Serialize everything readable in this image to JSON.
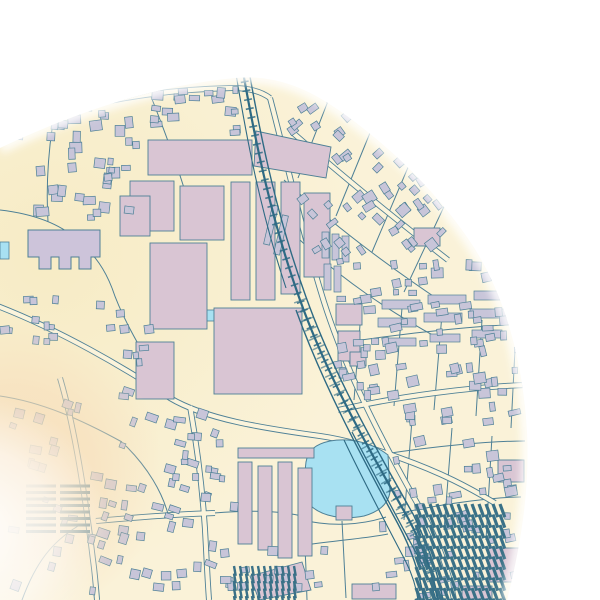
{
  "map": {
    "size": {
      "w": 600,
      "h": 600
    },
    "palette": {
      "land": "#faf2d8",
      "road_fill": "#fbf4dc",
      "west_tint": "#f5e8bb",
      "line": "#4e8096",
      "industrial": "#d9c5d3",
      "residential": "#c8c5d9",
      "landmark": "#cdc4da",
      "water": "#a8e1f2",
      "rail": "#2e6a84",
      "hatch": "#3a7187",
      "fade_peach": "#f7ddba",
      "outside": "#ffffff"
    },
    "mask": {
      "path": "M 0,148 C 70,115 150,86 235,78 C 282,74 315,93 347,116 C 392,149 436,191 471,243 C 505,294 523,362 527,432 C 530,492 520,548 507,600 L 0,600 Z",
      "edge_path": "M 0,148 C 70,115 150,86 235,78 C 282,74 315,93 347,116 C 392,149 436,191 471,243 C 505,294 523,362 527,432 C 530,492 520,548 507,600",
      "edge_blur": 4.5,
      "edge_width": 11
    },
    "zones": {
      "west_tint": {
        "cx": 50,
        "cy": 255,
        "r": 320
      },
      "peach_fade": {
        "cx": 14,
        "cy": 472,
        "r": 150
      },
      "white_fade": {
        "cx": -28,
        "cy": 532,
        "r": 138
      }
    },
    "roads": {
      "major": [
        "M -5,305 C 60,330 125,368 170,398 C 205,419 262,428 320,436 C 348,440 372,448 400,458 C 442,473 468,487 495,503",
        "M 190,406 C 198,452 204,502 206,548 C 207,568 208,586 209,600",
        "M 52,114 C 122,96 176,89 232,88 C 250,88 262,92 270,98",
        "M 270,98 C 287,162 302,232 324,302 C 347,374 382,441 421,510 C 438,541 449,571 454,600",
        "M 338,410 C 400,396 472,387 525,385",
        "M 96,521 C 140,517 182,514 215,513",
        "M 60,378 C 76,432 86,502 93,560 C 95,574 96,588 97,600",
        "M 292,132 C 340,174 394,218 448,260"
      ],
      "minor": [
        "M 0,210 C 35,214 60,224 78,240 C 96,256 105,270 112,288",
        "M 112,288 C 122,318 145,358 172,398",
        "M 284,180 C 330,222 382,262 442,302",
        "M 300,240 C 340,278 390,312 438,338",
        "M 330,96 L 298,178",
        "M 372,128 L 336,216",
        "M 412,158 L 372,252",
        "M 448,198 L 404,292",
        "M 348,342 C 420,331 490,325 526,324",
        "M 362,300 L 354,400",
        "M 402,308 L 394,406",
        "M 442,314 L 434,410",
        "M 482,320 L 476,416",
        "M 516,330 L 511,428",
        "M 372,456 C 432,446 492,441 525,441",
        "M 396,514 C 450,502 500,497 521,497",
        "M 412,420 L 404,520",
        "M 452,428 L 444,530",
        "M 492,436 L 486,540",
        "M 0,396 C 42,402 82,420 122,442",
        "M 126,446 C 148,468 162,492 168,514",
        "M 22,600 C 36,562 52,542 78,526",
        "M 214,513 C 262,509 292,512 312,519",
        "M 302,522 C 306,548 306,574 307,600",
        "M 305,545 C 340,540 368,538 388,534",
        "M 342,521 L 346,598",
        "M 304,520 C 330,527 362,525 386,517",
        "M 148,89 C 162,124 174,156 184,188",
        "M 54,116 C 48,152 46,188 48,222",
        "M 98,95 C 120,92 135,90 150,89"
      ]
    },
    "railway": {
      "tracks": [
        {
          "d": "M 243,72 C 256,145 272,222 300,300 C 328,378 368,448 408,518 C 424,548 433,574 438,600",
          "w": 2.2
        },
        {
          "d": "M 249,71 C 262,144 278,220 306,297 C 334,375 374,445 413,514 C 428,545 438,572 443,600",
          "w": 1.4
        },
        {
          "d": "M 296,310 C 322,382 358,450 398,524 C 412,550 420,575 424,600",
          "w": 1.4
        },
        {
          "d": "M 236,74 C 247,140 260,210 286,288",
          "w": 1.1
        },
        {
          "d": "M 352,432 C 372,470 396,516 420,560 C 428,576 433,588 436,600",
          "w": 1.3
        },
        {
          "d": "M 344,440 C 362,478 384,520 406,562 C 412,574 416,586 418,600",
          "w": 1.1
        }
      ],
      "ties": [
        {
          "d": "M 243,72 C 256,145 272,222 300,300 C 328,378 368,448 408,518 C 424,548 433,574 438,600",
          "w": 8,
          "dash": "1.6 7.5",
          "opacity": 0.85
        },
        {
          "d": "M 300,300 C 328,378 368,448 408,518 C 424,548 433,574 438,600",
          "w": 13,
          "dash": "1.5 8.5",
          "opacity": 0.6
        }
      ]
    },
    "water": {
      "pond": "M 306,462 C 308,450 316,444 330,441 C 352,437 374,444 388,455 L 390,492 C 388,505 378,512 364,516 C 344,520 322,517 310,505 C 304,496 304,478 306,462 Z",
      "patches": [
        {
          "x": 0,
          "y": 242,
          "w": 9,
          "h": 17
        },
        {
          "x": 203,
          "y": 310,
          "w": 11,
          "h": 11
        }
      ]
    },
    "buildings": {
      "landmark": "M 28,230 L 100,230 L 100,257 L 91,257 L 91,269 L 79,269 L 79,257 L 71,257 L 71,269 L 59,269 L 59,257 L 51,257 L 51,269 L 39,269 L 39,257 L 28,257 Z",
      "industrial": [
        {
          "x": 148,
          "y": 140,
          "w": 104,
          "h": 35
        },
        {
          "x": 130,
          "y": 181,
          "w": 44,
          "h": 50
        },
        {
          "x": 180,
          "y": 186,
          "w": 44,
          "h": 54
        },
        {
          "x": 231,
          "y": 182,
          "w": 19,
          "h": 118
        },
        {
          "x": 256,
          "y": 182,
          "w": 19,
          "h": 118
        },
        {
          "x": 281,
          "y": 182,
          "w": 19,
          "h": 112
        },
        {
          "x": 150,
          "y": 243,
          "w": 57,
          "h": 86
        },
        {
          "x": 214,
          "y": 308,
          "w": 88,
          "h": 86
        },
        {
          "x": 136,
          "y": 342,
          "w": 38,
          "h": 57
        },
        {
          "pts": "256,131 331,147 326,178 254,166"
        },
        {
          "x": 304,
          "y": 193,
          "w": 26,
          "h": 84
        },
        {
          "x": 120,
          "y": 196,
          "w": 30,
          "h": 40
        },
        {
          "x": 336,
          "y": 304,
          "w": 26,
          "h": 21
        },
        {
          "x": 338,
          "y": 331,
          "w": 22,
          "h": 30
        },
        {
          "x": 350,
          "y": 352,
          "w": 16,
          "h": 14
        },
        {
          "x": 238,
          "y": 448,
          "w": 76,
          "h": 10
        },
        {
          "x": 238,
          "y": 462,
          "w": 14,
          "h": 82
        },
        {
          "x": 258,
          "y": 466,
          "w": 14,
          "h": 84
        },
        {
          "x": 278,
          "y": 462,
          "w": 14,
          "h": 96
        },
        {
          "x": 298,
          "y": 468,
          "w": 14,
          "h": 88
        },
        {
          "pts": "250,576 302,562 311,590 259,600"
        },
        {
          "x": 352,
          "y": 584,
          "w": 44,
          "h": 15
        },
        {
          "x": 488,
          "y": 548,
          "w": 40,
          "h": 34
        },
        {
          "x": 462,
          "y": 586,
          "w": 30,
          "h": 13
        },
        {
          "x": 468,
          "y": 196,
          "w": 34,
          "h": 32
        },
        {
          "x": 498,
          "y": 460,
          "w": 26,
          "h": 22
        },
        {
          "x": 414,
          "y": 228,
          "w": 26,
          "h": 18
        },
        {
          "x": 336,
          "y": 506,
          "w": 16,
          "h": 14
        }
      ],
      "rows": [
        {
          "x": 382,
          "y": 300,
          "w": 38,
          "h": 9
        },
        {
          "x": 428,
          "y": 295,
          "w": 38,
          "h": 9
        },
        {
          "x": 474,
          "y": 291,
          "w": 38,
          "h": 9
        },
        {
          "x": 378,
          "y": 318,
          "w": 38,
          "h": 9
        },
        {
          "x": 424,
          "y": 313,
          "w": 38,
          "h": 9
        },
        {
          "x": 470,
          "y": 309,
          "w": 38,
          "h": 9
        },
        {
          "x": 386,
          "y": 338,
          "w": 30,
          "h": 8
        },
        {
          "x": 430,
          "y": 334,
          "w": 30,
          "h": 8
        },
        {
          "x": 472,
          "y": 330,
          "w": 30,
          "h": 8
        },
        {
          "x": 322,
          "y": 232,
          "w": 7,
          "h": 26
        },
        {
          "x": 332,
          "y": 234,
          "w": 7,
          "h": 26
        },
        {
          "x": 342,
          "y": 236,
          "w": 7,
          "h": 26
        },
        {
          "x": 324,
          "y": 264,
          "w": 7,
          "h": 26
        },
        {
          "x": 334,
          "y": 266,
          "w": 7,
          "h": 26
        },
        {
          "x": 268,
          "y": 205,
          "w": 6,
          "h": 40,
          "rot": 13
        },
        {
          "x": 278,
          "y": 215,
          "w": 6,
          "h": 40,
          "rot": 13
        }
      ],
      "clusters": [
        {
          "x": 4,
          "y": 96,
          "w": 142,
          "h": 128,
          "count": 46,
          "min": 5,
          "max": 13,
          "angle": 0,
          "seed": 7
        },
        {
          "x": 148,
          "y": 84,
          "w": 100,
          "h": 52,
          "count": 18,
          "min": 5,
          "max": 12,
          "angle": 0,
          "seed": 11
        },
        {
          "x": 286,
          "y": 94,
          "w": 162,
          "h": 162,
          "count": 64,
          "min": 5,
          "max": 12,
          "angle": -38,
          "seed": 23
        },
        {
          "x": 334,
          "y": 258,
          "w": 194,
          "h": 142,
          "count": 78,
          "min": 5,
          "max": 12,
          "angle": -6,
          "seed": 31
        },
        {
          "x": 370,
          "y": 402,
          "w": 158,
          "h": 196,
          "count": 58,
          "min": 5,
          "max": 12,
          "angle": -6,
          "seed": 43
        },
        {
          "x": 4,
          "y": 384,
          "w": 220,
          "h": 212,
          "count": 66,
          "min": 5,
          "max": 12,
          "angle": 14,
          "seed": 53
        },
        {
          "x": 152,
          "y": 542,
          "w": 176,
          "h": 54,
          "count": 20,
          "min": 5,
          "max": 11,
          "angle": 0,
          "seed": 61
        },
        {
          "x": 172,
          "y": 430,
          "w": 66,
          "h": 86,
          "count": 11,
          "min": 5,
          "max": 10,
          "angle": 0,
          "seed": 71
        },
        {
          "x": 96,
          "y": 300,
          "w": 58,
          "h": 66,
          "count": 9,
          "min": 5,
          "max": 10,
          "angle": 0,
          "seed": 83
        },
        {
          "x": 0,
          "y": 280,
          "w": 68,
          "h": 66,
          "count": 11,
          "min": 5,
          "max": 10,
          "angle": 0,
          "seed": 97
        }
      ]
    },
    "hatches": [
      {
        "x": 416,
        "y": 504,
        "w": 88,
        "h": 96,
        "angle": 70,
        "gap": 7,
        "len": 14,
        "lw": 3.2
      },
      {
        "x": 26,
        "y": 486,
        "w": 40,
        "h": 50,
        "angle": 0,
        "gap": 7,
        "len": 30,
        "lw": 3
      },
      {
        "x": 234,
        "y": 566,
        "w": 62,
        "h": 34,
        "angle": 80,
        "gap": 6,
        "len": 10,
        "lw": 2.4
      }
    ]
  }
}
